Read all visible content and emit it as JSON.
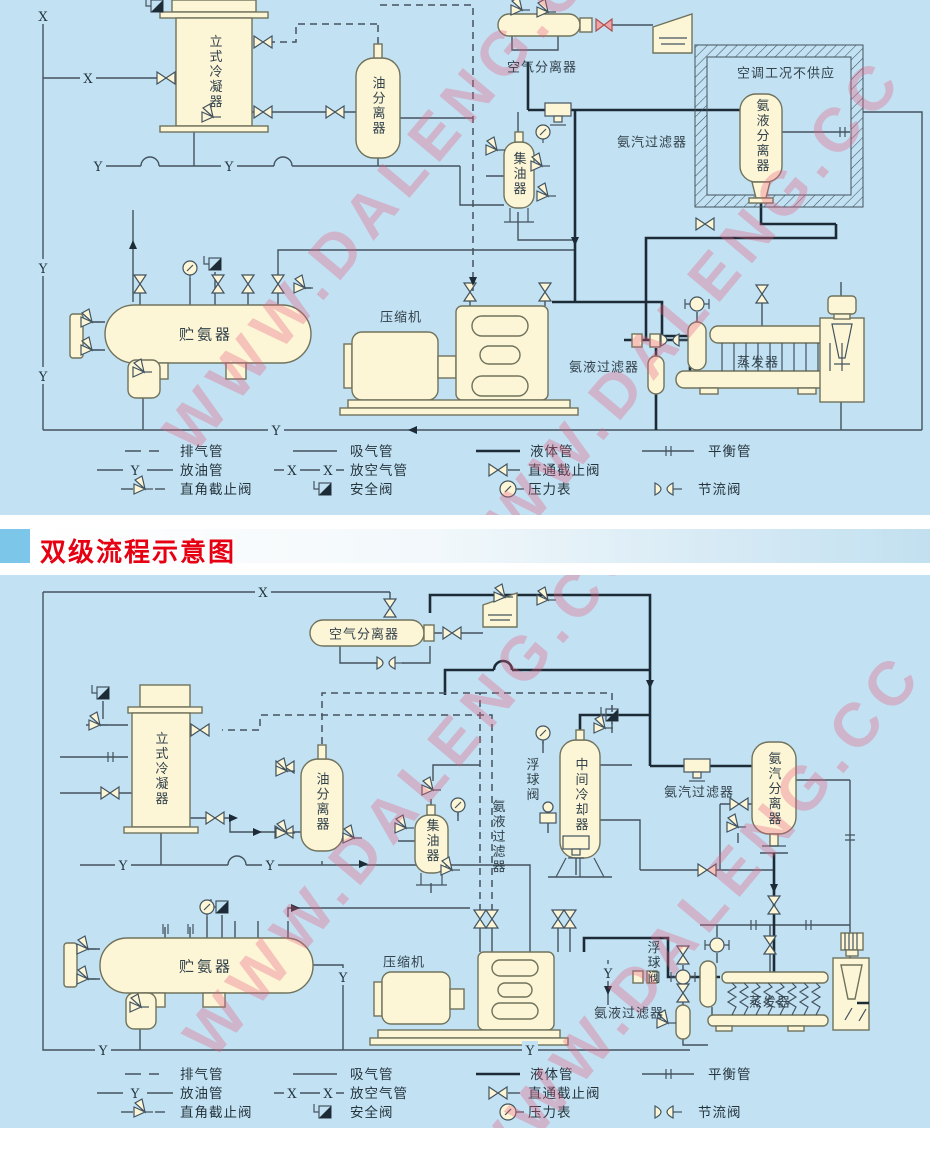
{
  "colors": {
    "panel_bg": "#c2e2f4",
    "vessel_fill": "#fcf6d7",
    "vessel_stroke": "#70725c",
    "pipe": "#44535e",
    "pipe_dark": "#1c2b36",
    "title_red": "#e60012",
    "band_blue": "#7cc6ea",
    "watermark_pink": "#e85d7d",
    "red_valve_fill": "#eda5a5"
  },
  "watermark": {
    "text": "WWW.DALENG.CC"
  },
  "section_title": "双级流程示意图",
  "markers": {
    "x": "X",
    "y": "Y"
  },
  "diagram1": {
    "labels": {
      "vertical_condenser": "立式冷凝器",
      "oil_separator": "油分离器",
      "air_separator": "空气分离器",
      "ac_note": "空调工况不供应",
      "ammonia_vapor_filter": "氨汽过滤器",
      "ammonia_liquid_separator": "氨液分离器",
      "oil_collector": "集油器",
      "ammonia_receiver": "贮氨器",
      "compressor": "压缩机",
      "ammonia_liquid_filter": "氨液过滤器",
      "evaporator": "蒸发器"
    }
  },
  "diagram2": {
    "labels": {
      "air_separator": "空气分离器",
      "vertical_condenser": "立式冷凝器",
      "oil_separator": "油分离器",
      "oil_collector": "集油器",
      "ammonia_liquid_filter_mid": "氨液过滤器",
      "float_valve_upper": "浮球阀",
      "intercooler": "中间冷却器",
      "ammonia_vapor_filter": "氨汽过滤器",
      "ammonia_vapor_separator": "氨汽分离器",
      "ammonia_receiver": "贮氨器",
      "compressor": "压缩机",
      "float_valve_lower": "浮球阀",
      "ammonia_liquid_filter": "氨液过滤器",
      "evaporator": "蒸发器"
    }
  },
  "legend": {
    "items": [
      {
        "key": "dash",
        "label": "排气管"
      },
      {
        "key": "solid",
        "label": "吸气管"
      },
      {
        "key": "thick",
        "label": "液体管"
      },
      {
        "key": "balance",
        "label": "平衡管"
      },
      {
        "key": "oil",
        "label": "放油管"
      },
      {
        "key": "air",
        "label": "放空气管"
      },
      {
        "key": "globe",
        "label": "直通截止阀"
      },
      {
        "key": "angle",
        "label": "直角截止阀"
      },
      {
        "key": "safety",
        "label": "安全阀"
      },
      {
        "key": "gauge",
        "label": "压力表"
      },
      {
        "key": "throttle",
        "label": "节流阀"
      }
    ]
  }
}
